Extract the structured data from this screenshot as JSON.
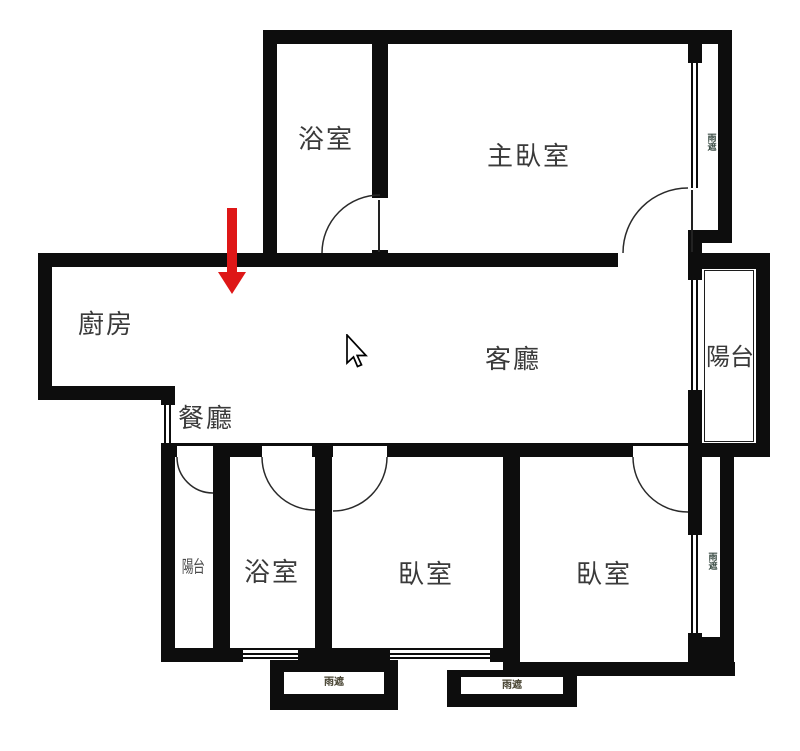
{
  "rooms": {
    "bathroom_top": "浴室",
    "master_bedroom": "主臥室",
    "kitchen": "廚房",
    "dining_room": "餐廳",
    "living_room": "客廳",
    "balcony": "陽台",
    "utility_balcony": "陽台",
    "bathroom_bottom": "浴室",
    "bedroom_left": "臥室",
    "bedroom_right": "臥室"
  },
  "canopies": {
    "top_right": "雨遮",
    "bottom_right": "雨遮",
    "bottom_box_left": "雨遮",
    "bottom_box_right": "雨遮"
  },
  "colors": {
    "wall": "#0d0d0d",
    "label": "#3a3a3a",
    "tiny_label": "#3f5049",
    "arrow": "#de1717",
    "background": "#ffffff"
  }
}
